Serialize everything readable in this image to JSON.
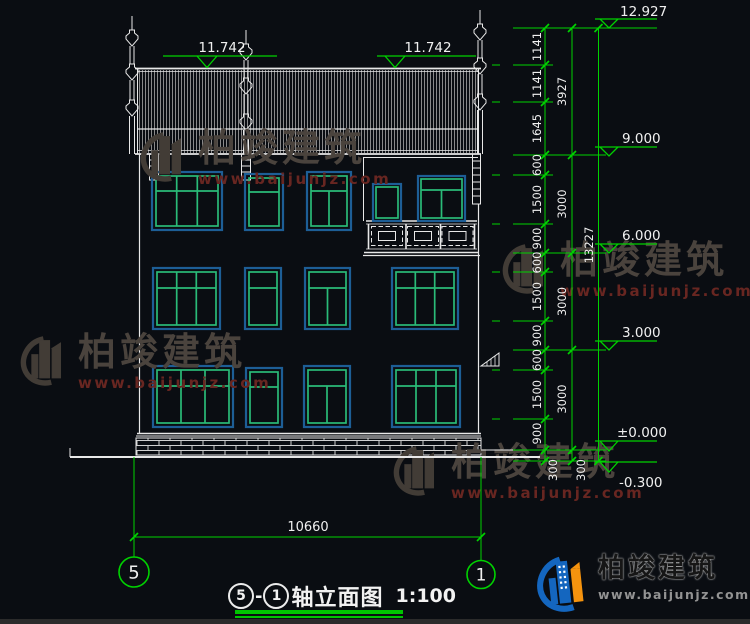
{
  "watermark": {
    "brand": "柏竣建筑",
    "url": "www.baijunjz.com"
  },
  "logo": {
    "brand": "柏竣建筑",
    "url": "www.baijunjz.com"
  },
  "title_block": {
    "axis_start": "5",
    "separator": "-",
    "axis_end": "1",
    "name": "轴立面图",
    "scale": "1:100"
  },
  "axes": {
    "left": "5",
    "right": "1"
  },
  "levels": {
    "roof_left": "11.742",
    "roof_right": "11.742",
    "ridge": "12.927",
    "f3": "9.000",
    "f2": "6.000",
    "f1": "3.000",
    "ground": "±0.000",
    "site": "-0.300"
  },
  "dims": {
    "total_width": "10660",
    "total_height": "13227",
    "chain_detail": [
      "1141",
      "1141",
      "1645",
      "600",
      "1500",
      "900",
      "600",
      "1500",
      "900",
      "600",
      "1500",
      "900",
      "300"
    ],
    "chain_floor": [
      "3927",
      "3000",
      "3000",
      "3000",
      "300"
    ]
  },
  "colors": {
    "dim_green": "#00d200",
    "window_green": "#2abb78",
    "window_frame_blue": "#1d5e96",
    "line_white": "#e8e8e8",
    "logo_blue": "#1466bf",
    "logo_orange": "#f5930e"
  }
}
